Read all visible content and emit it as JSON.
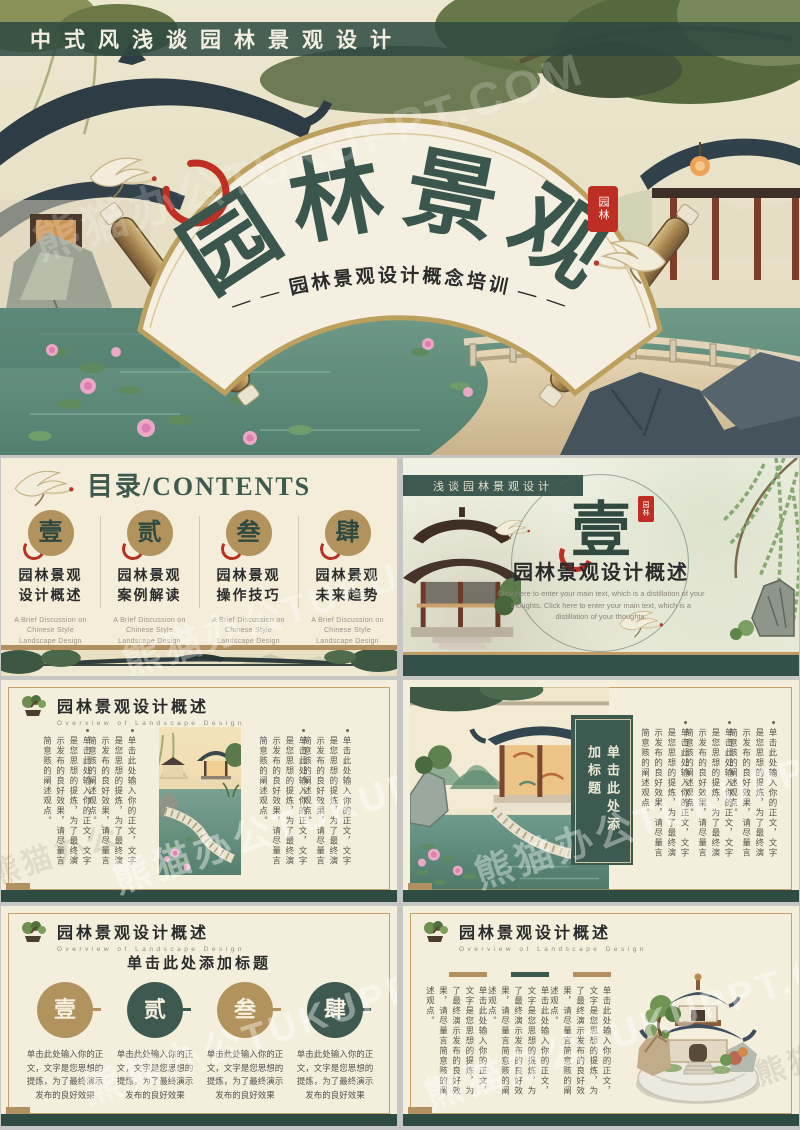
{
  "watermark": {
    "main": "熊猫办公TUKUPPT.COM",
    "side": "熊猫办公"
  },
  "cover": {
    "banner": "中式风浅谈园林景观设计",
    "title": "园林景观",
    "subtitle": "— —  园林景观设计概念培训  — —",
    "seal": "园林"
  },
  "contents": {
    "title": "目录/CONTENTS",
    "items": [
      {
        "num": "壹",
        "line1": "园林景观",
        "line2": "设计概述",
        "en": "A Brief Discussion on Chinese Style Landscape Design"
      },
      {
        "num": "贰",
        "line1": "园林景观",
        "line2": "案例解读",
        "en": "A Brief Discussion on Chinese Style Landscape Design"
      },
      {
        "num": "叁",
        "line1": "园林景观",
        "line2": "操作技巧",
        "en": "A Brief Discussion on Chinese Style Landscape Design"
      },
      {
        "num": "肆",
        "line1": "园林景观",
        "line2": "未来趋势",
        "en": "A Brief Discussion on Chinese Style Landscape Design"
      }
    ]
  },
  "section": {
    "ribbon": "浅谈园林景观设计",
    "number": "壹",
    "seal": "园林",
    "title": "园林景观设计概述",
    "body": "Click here to enter your main text, which is a distillation of your thoughts. Click here to enter your main text, which is a distillation of your thoughts."
  },
  "content_header": {
    "title": "园林景观设计概述",
    "subtitle": "Overview of Landscape Design"
  },
  "placeholder": {
    "long": "单击此处输入你的正文，文字是您思想的提炼，为了最终演示发布的良好效果，请尽量言简意赅的阐述观点。",
    "short": "单击此处输入你的正文，文字是您思想的提炼，为了最终演示发布的良好效果"
  },
  "slide5": {
    "box_title": "单击此处添加标题"
  },
  "slide6": {
    "title": "单击此处添加标题",
    "nums": [
      "壹",
      "贰",
      "叁",
      "肆"
    ]
  }
}
